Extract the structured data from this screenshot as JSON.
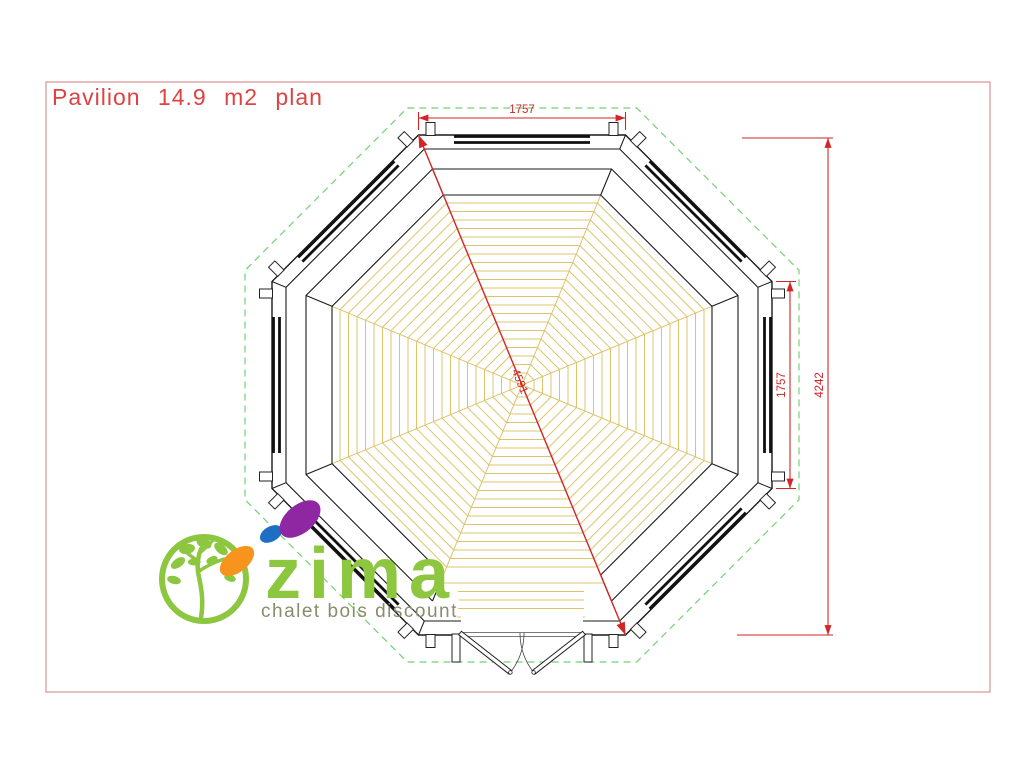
{
  "page": {
    "title": "Pavilion 14.9 m2 plan"
  },
  "drawing": {
    "type": "octagonal pavilion floor plan",
    "dimensions": {
      "top_width_mm": "1757",
      "right_side_mm": "1757",
      "overall_depth_mm": "4242",
      "diagonal_mm": "4591"
    }
  },
  "logo": {
    "brand": "zima",
    "tagline": "chalet bois discount"
  },
  "colors": {
    "title_red": "#dd4343",
    "dimension_red": "#d22626",
    "roof_outline_green": "#74d174",
    "floor_tan": "#ddc46c",
    "wall_black": "#1a1a1a",
    "border_pink": "#d89494",
    "logo_green": "#8dc63f",
    "logo_orange": "#f7941d",
    "logo_purple": "#8f27a3",
    "logo_blue": "#1e6fc4",
    "tagline_olive": "#8b8b6e"
  }
}
